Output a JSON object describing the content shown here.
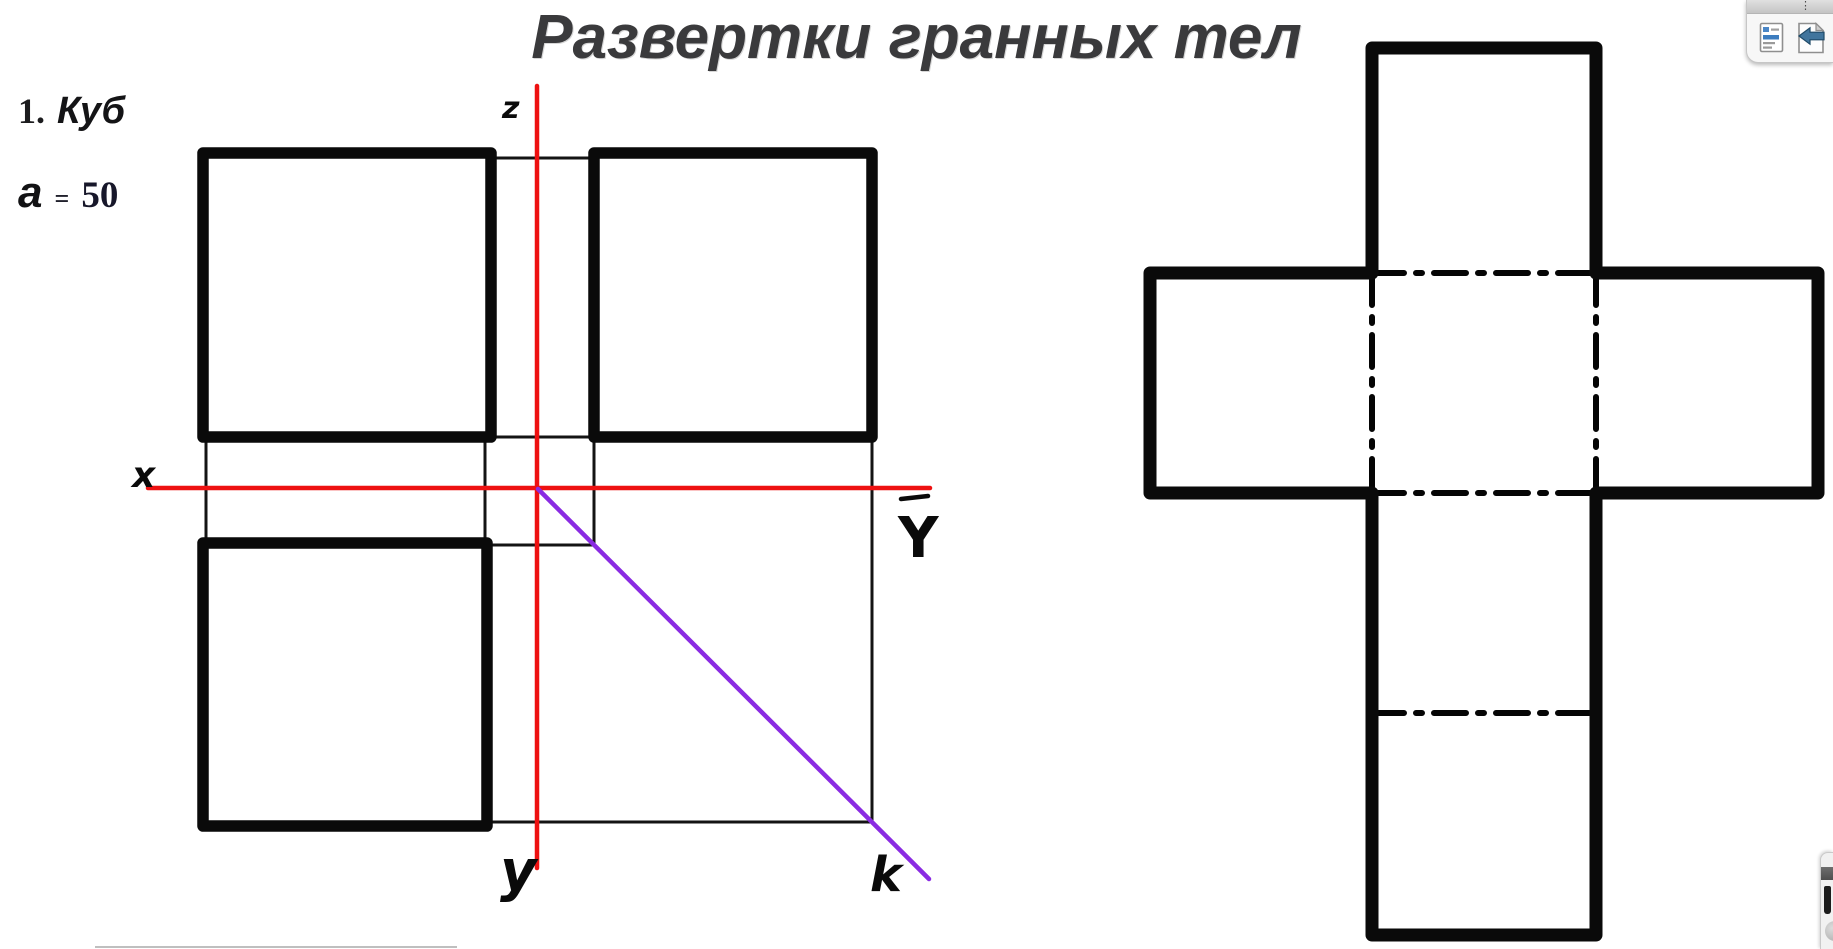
{
  "title": "Развертки гранных тел",
  "section": {
    "number": "1.",
    "name": "Куб"
  },
  "parameter": {
    "symbol": "a",
    "equals": "=",
    "value": "50"
  },
  "axes": {
    "z": "z",
    "x": "x",
    "y": "y",
    "y_bar": "Y",
    "k": "k"
  },
  "colors": {
    "title_gray": "#3a3a3c",
    "ink_black": "#0a0a0a",
    "axis_red": "#ee1111",
    "diagonal_purple": "#8a2be2",
    "toolbar_arrow_blue": "#41759d",
    "toolbar_list_blue": "#3d7dbf"
  },
  "toolbar_top_right": {
    "menu_dots": "⋮",
    "icons": [
      "page-list-icon",
      "page-back-icon"
    ]
  },
  "toolbar_bottom_right": {
    "icons": [
      "pen-tool-icon",
      "knob-icon"
    ]
  }
}
